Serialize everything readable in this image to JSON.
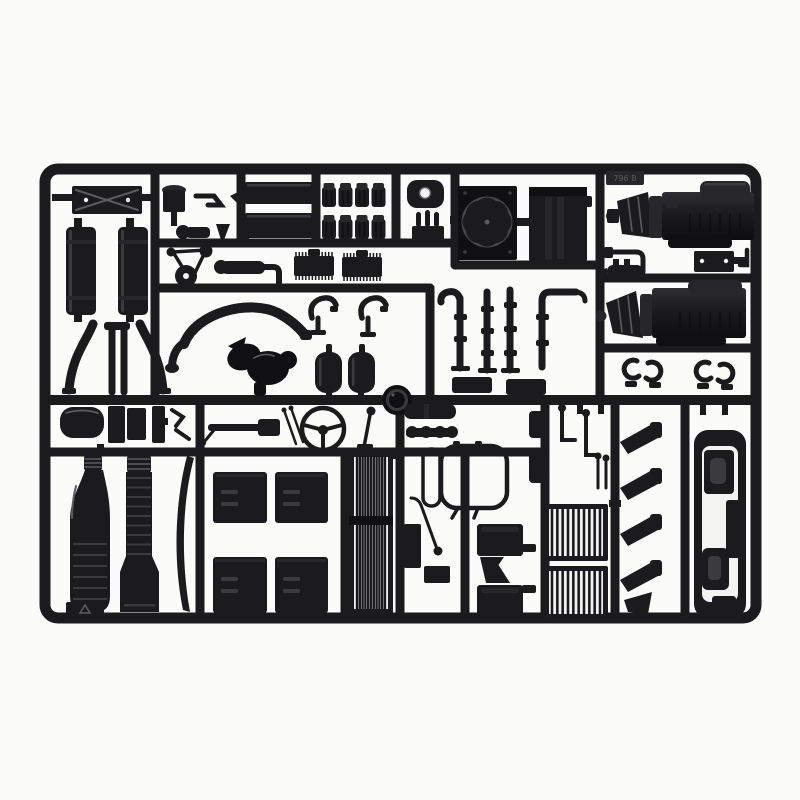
{
  "image": {
    "description": "injection-molded black plastic model kit sprue with truck engine and chassis parts, photographed on a white background",
    "background": "#fbfbfa",
    "colors": {
      "plastic": "#1b1b1e",
      "plastic_dark": "#101013",
      "plastic_mid": "#27272b",
      "plastic_light": "#3a3a3f",
      "sheen": "#5b5b60",
      "disc": "#47474c",
      "white": "#f3f3f2"
    },
    "mold_tag": "796 B"
  },
  "generated": {
    "fan_blade_count": 8,
    "heater_grille_slats": 11,
    "step_grille_slats": 10,
    "valve_cover_units_per_row": 4,
    "valve_cover_rows": 2,
    "intercooler_fins": 12,
    "column_ribs": 9,
    "flask_ribs": 6
  }
}
